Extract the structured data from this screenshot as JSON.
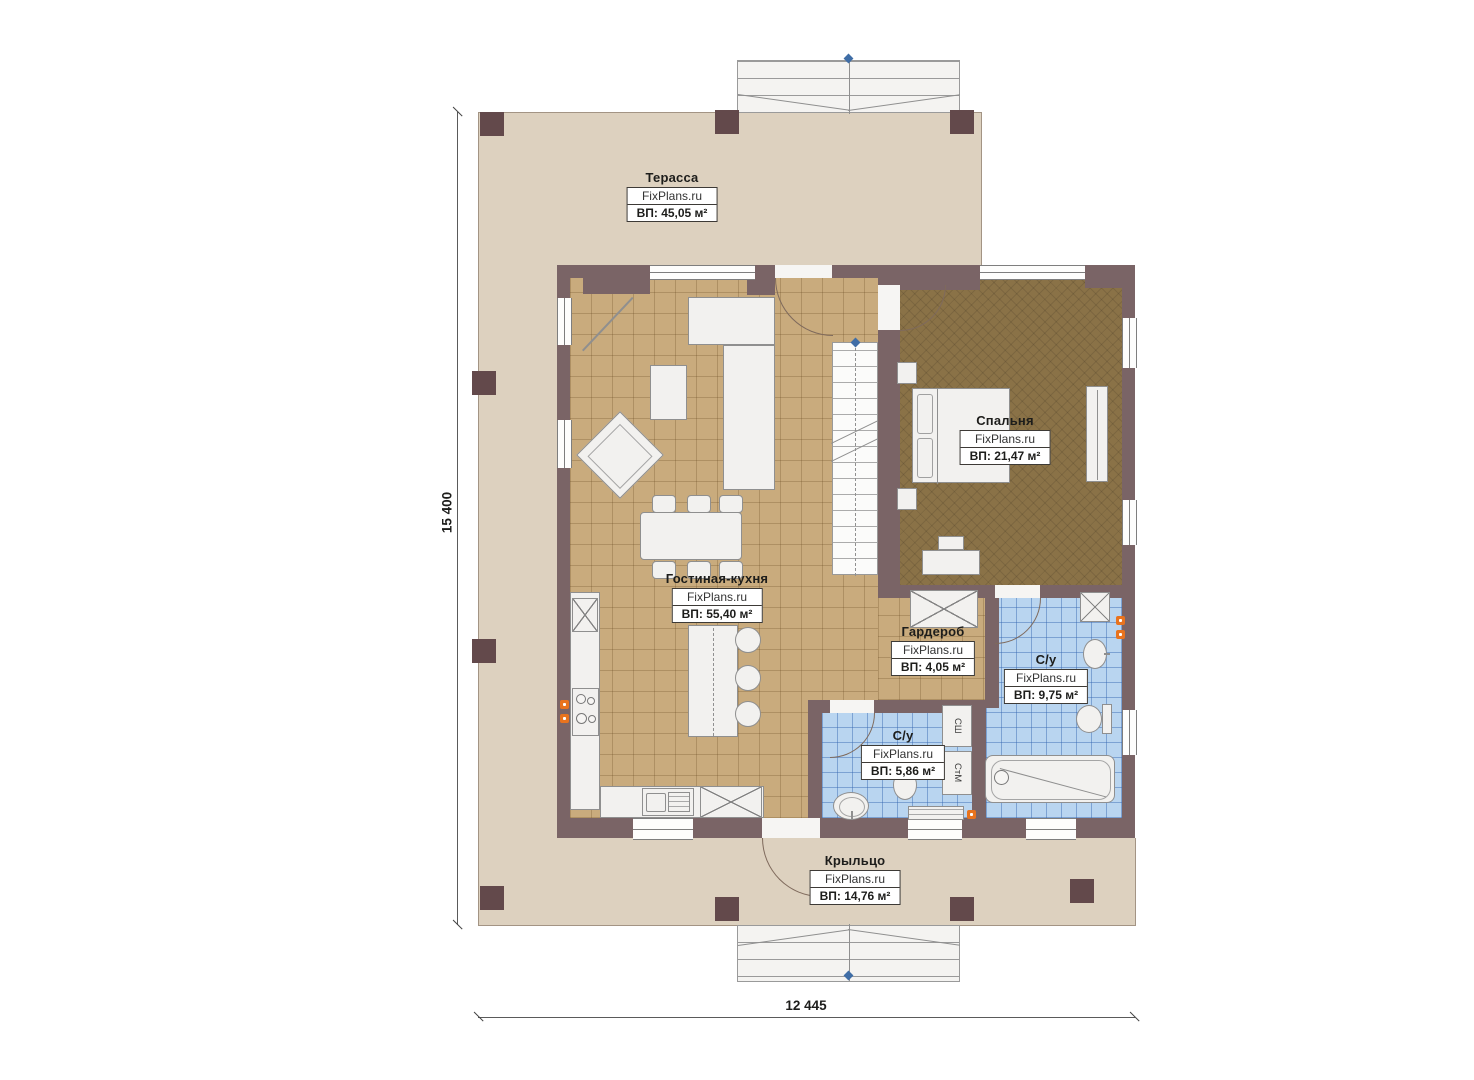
{
  "site": "FixPlans.ru",
  "rooms": {
    "terrace": {
      "name": "Терасса",
      "brand": "FixPlans.ru",
      "area": "ВП: 45,05 м²"
    },
    "bedroom": {
      "name": "Спальня",
      "brand": "FixPlans.ru",
      "area": "ВП: 21,47 м²"
    },
    "living": {
      "name": "Гостиная-кухня",
      "brand": "FixPlans.ru",
      "area": "ВП: 55,40 м²"
    },
    "wardrobe": {
      "name": "Гардероб",
      "brand": "FixPlans.ru",
      "area": "ВП: 4,05 м²"
    },
    "bath_big": {
      "name": "С/у",
      "brand": "FixPlans.ru",
      "area": "ВП: 9,75 м²"
    },
    "bath_small": {
      "name": "С/у",
      "brand": "FixPlans.ru",
      "area": "ВП: 5,86 м²"
    },
    "porch": {
      "name": "Крыльцо",
      "brand": "FixPlans.ru",
      "area": "ВП: 14,76 м²"
    }
  },
  "dimensions": {
    "vertical": "15 400",
    "horizontal": "12 445"
  },
  "appliances": {
    "dryer": "СШ",
    "washer": "СтМ"
  },
  "icons": {
    "level_marker": "blue-diamond",
    "outlet": "orange-dot"
  },
  "colors": {
    "wall": "#7a6466",
    "terrace": "#ddd1bf",
    "floor_living": "#c9ab7d",
    "floor_bedroom": "#8a7247",
    "floor_bath": "#b9d5f0",
    "outlet": "#e8731e",
    "marker": "#3f6da6"
  }
}
